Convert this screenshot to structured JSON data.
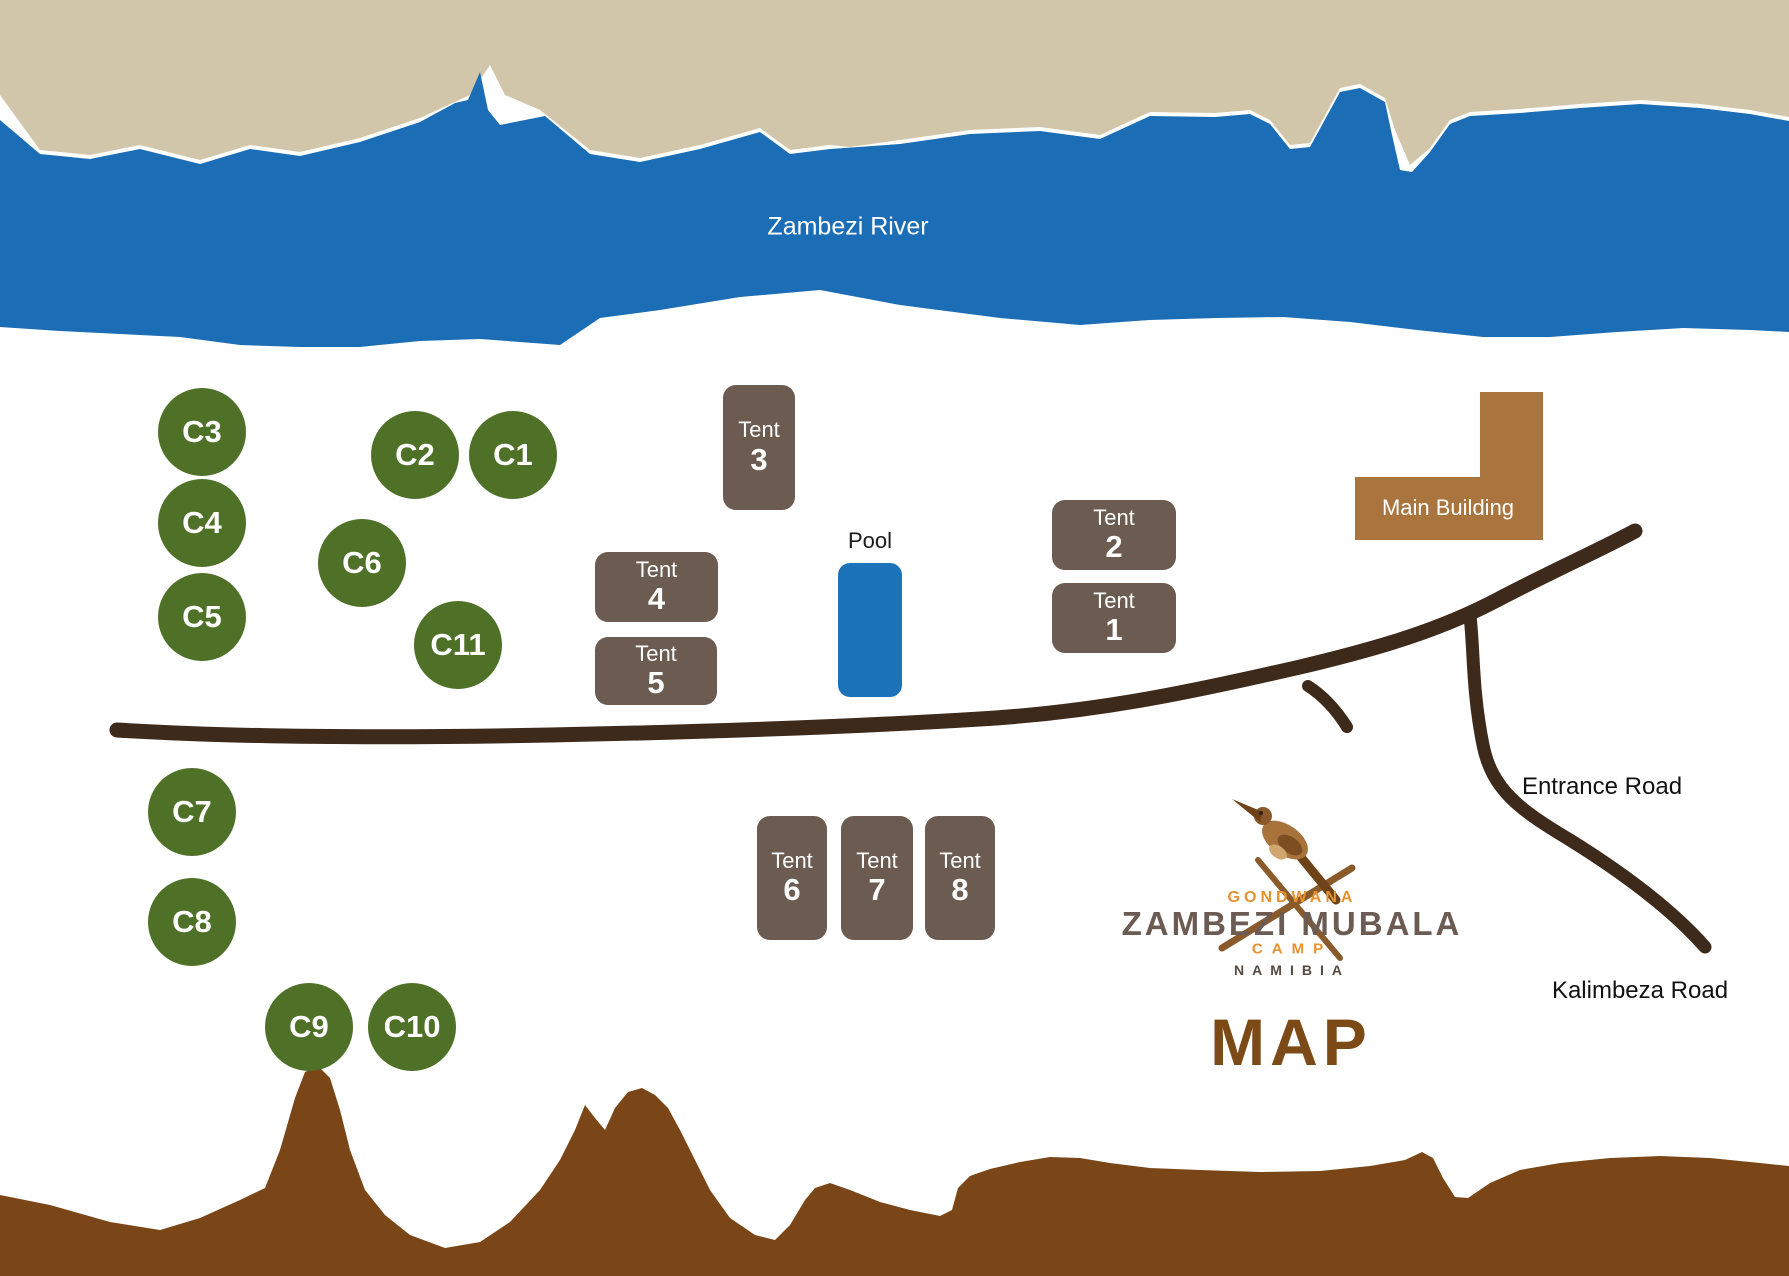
{
  "labels": {
    "river": "Zambezi River",
    "pool": "Pool",
    "main_building": "Main Building",
    "entrance_road": "Entrance Road",
    "kalimbeza_road": "Kalimbeza Road",
    "map_title": "MAP"
  },
  "campsites": [
    {
      "label": "C1"
    },
    {
      "label": "C2"
    },
    {
      "label": "C3"
    },
    {
      "label": "C4"
    },
    {
      "label": "C5"
    },
    {
      "label": "C6"
    },
    {
      "label": "C7"
    },
    {
      "label": "C8"
    },
    {
      "label": "C9"
    },
    {
      "label": "C10"
    },
    {
      "label": "C11"
    }
  ],
  "tents": [
    {
      "word": "Tent",
      "number": "1"
    },
    {
      "word": "Tent",
      "number": "2"
    },
    {
      "word": "Tent",
      "number": "3"
    },
    {
      "word": "Tent",
      "number": "4"
    },
    {
      "word": "Tent",
      "number": "5"
    },
    {
      "word": "Tent",
      "number": "6"
    },
    {
      "word": "Tent",
      "number": "7"
    },
    {
      "word": "Tent",
      "number": "8"
    }
  ],
  "logo": {
    "group": "GONDWANA",
    "name": "ZAMBEZI MUBALA",
    "type": "CAMP",
    "country": "NAMIBIA"
  },
  "colors": {
    "river_blue": "#1b6db5",
    "far_bank_tan": "#d2c6aa",
    "campsite_green": "#4e7127",
    "tent_brown": "#6b5b50",
    "main_building_brown": "#a9743e",
    "road_dark_brown": "#3e2a1b",
    "terrain_brown": "#7a4617",
    "pool_blue": "#1c73b9",
    "map_title_brown": "#7b4a16",
    "logo_orange": "#e8922f",
    "logo_gray_brown": "#6b5b53"
  }
}
